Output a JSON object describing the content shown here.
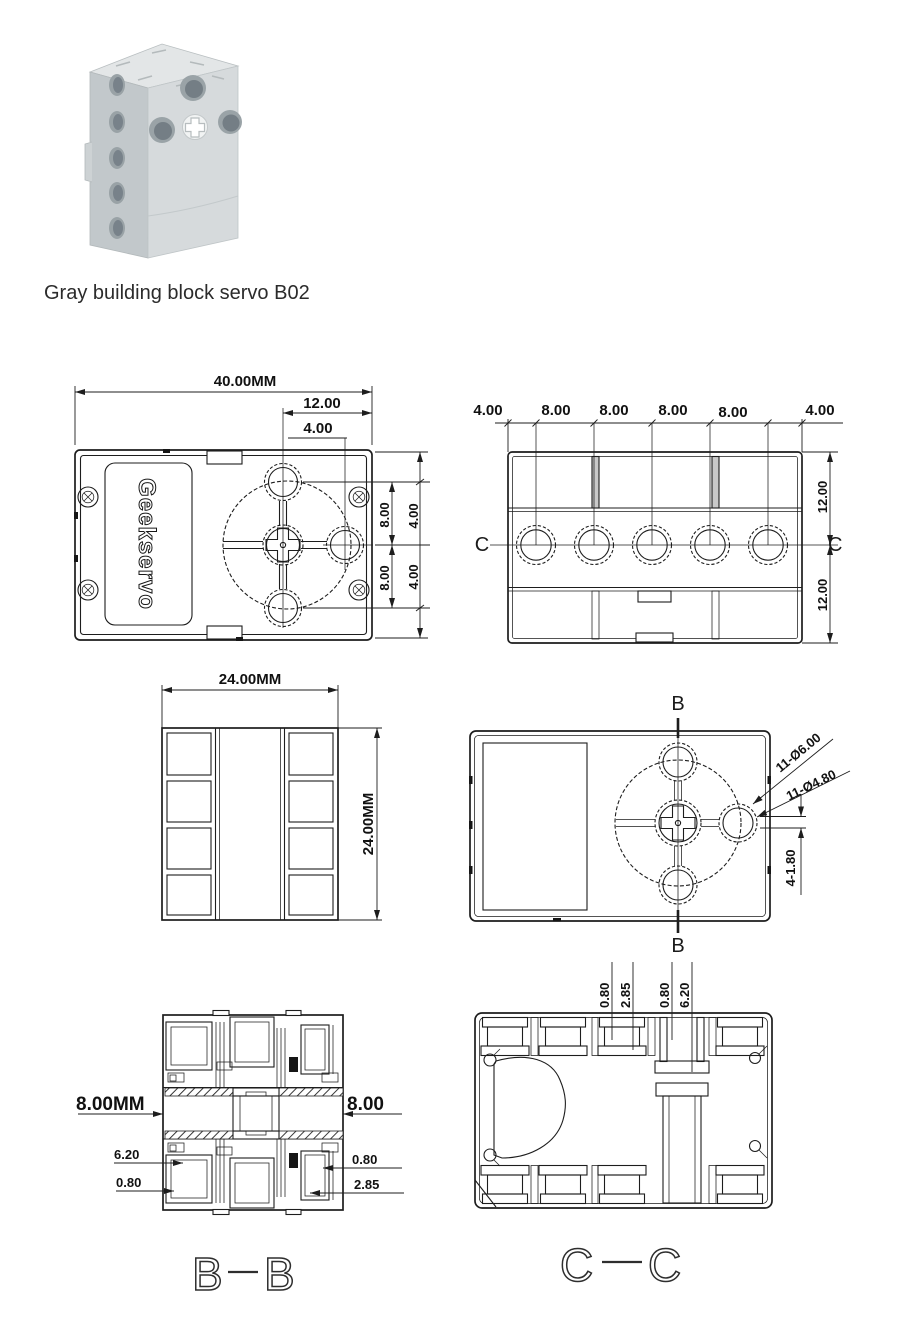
{
  "product": {
    "caption": "Gray building block servo B02"
  },
  "brand": {
    "logo_text": "Geekservo"
  },
  "front_view": {
    "dim_width": "40.00MM",
    "dim_center_offset": "12.00",
    "dim_hole_offset": "4.00",
    "dim_right_8_upper": "8.00",
    "dim_right_8_lower": "8.00",
    "dim_right_4_upper": "4.00",
    "dim_right_4_lower": "4.00"
  },
  "top_view": {
    "dims_top": [
      "4.00",
      "8.00",
      "8.00",
      "8.00",
      "8.00",
      "4.00"
    ],
    "dim_right_upper": "12.00",
    "dim_right_lower": "12.00",
    "section_label_left": "C",
    "section_label_right": "C"
  },
  "end_view": {
    "dim_width": "24.00MM",
    "dim_height": "24.00MM"
  },
  "back_view": {
    "section_label_top": "B",
    "section_label_bottom": "B",
    "callout_outer_holes": "11-Ø6.00",
    "callout_inner_holes": "11-Ø4.80",
    "dim_slots": "4-1.80"
  },
  "section_bb": {
    "dim_channel_left": "8.00MM",
    "dim_channel_right": "8.00",
    "dim_6_20": "6.20",
    "dim_0_80_left": "0.80",
    "dim_0_80_right": "0.80",
    "dim_2_85": "2.85",
    "title_left": "B",
    "title_right": "B"
  },
  "section_cc": {
    "dims_top": [
      "0.80",
      "2.85",
      "0.80",
      "6.20"
    ],
    "title_left": "C",
    "title_right": "C"
  }
}
